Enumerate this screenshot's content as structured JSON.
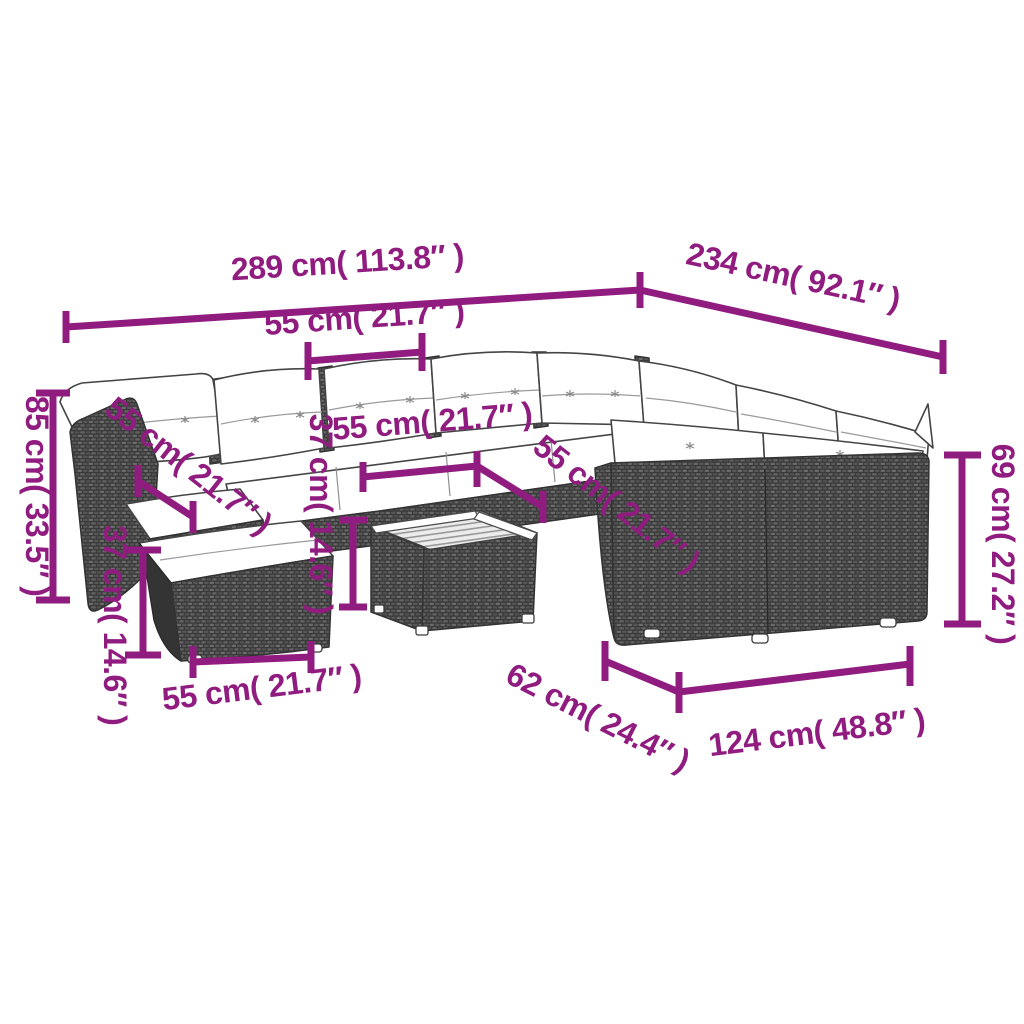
{
  "diagram": {
    "kind": "furniture dimension diagram",
    "subject": "poly rattan garden lounge set with white cushions, ottoman and slatted coffee table",
    "background": "#ffffff",
    "dimension_color": "#911c80",
    "outline_color": "#454545",
    "wicker_color": "#3b3b3b",
    "cushion_color": "#ffffff"
  },
  "annotations": [
    {
      "id": "overall-width",
      "label": "289 cm( 113.8″ )",
      "value_cm": 289,
      "value_in": 113.8
    },
    {
      "id": "overall-depth",
      "label": "234 cm( 92.1″ )",
      "value_cm": 234,
      "value_in": 92.1
    },
    {
      "id": "back-module-width",
      "label": "55 cm( 21.7″ )",
      "value_cm": 55,
      "value_in": 21.7
    },
    {
      "id": "total-height",
      "label": "85 cm( 33.5″ )",
      "value_cm": 85,
      "value_in": 33.5
    },
    {
      "id": "left-seat-width",
      "label": "55 cm( 21.7″ )",
      "value_cm": 55,
      "value_in": 21.7
    },
    {
      "id": "middle-seat-width",
      "label": "55 cm( 21.7″ )",
      "value_cm": 55,
      "value_in": 21.7
    },
    {
      "id": "right-seat-width",
      "label": "55 cm( 21.7″ )",
      "value_cm": 55,
      "value_in": 21.7
    },
    {
      "id": "left-seat-height",
      "label": "37 cm( 14.6″ )",
      "value_cm": 37,
      "value_in": 14.6
    },
    {
      "id": "middle-seat-height",
      "label": "37 cm( 14.6″ )",
      "value_cm": 37,
      "value_in": 14.6
    },
    {
      "id": "ottoman-width",
      "label": "55 cm( 21.7″ )",
      "value_cm": 55,
      "value_in": 21.7
    },
    {
      "id": "table-depth",
      "label": "62 cm( 24.4″ )",
      "value_cm": 62,
      "value_in": 24.4
    },
    {
      "id": "right-section-length",
      "label": "124 cm( 48.8″ )",
      "value_cm": 124,
      "value_in": 48.8
    },
    {
      "id": "backrest-height",
      "label": "69 cm( 27.2″ )",
      "value_cm": 69,
      "value_in": 27.2
    }
  ]
}
